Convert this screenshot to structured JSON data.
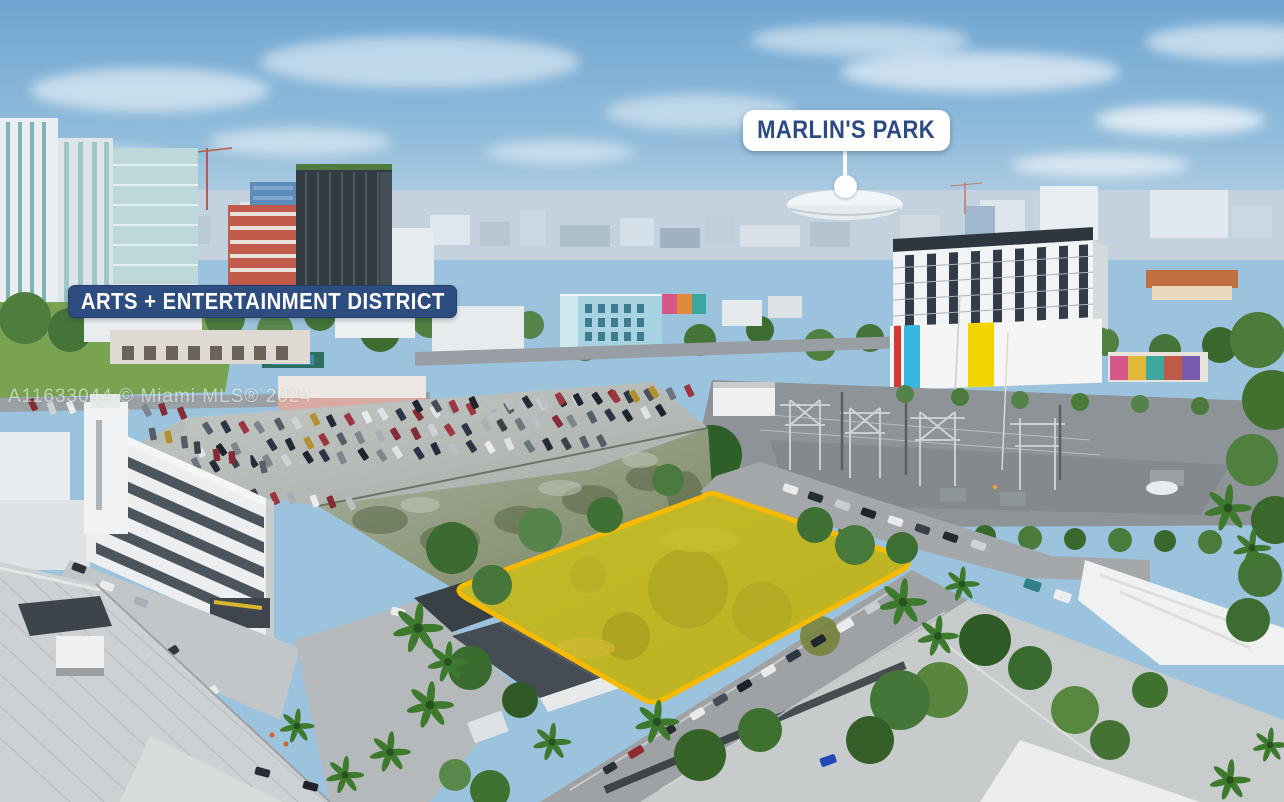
{
  "annotations": {
    "callout": {
      "label": "MARLIN'S PARK"
    },
    "district_banner": {
      "label": "ARTS + ENTERTAINMENT DISTRICT"
    },
    "watermark": {
      "text": "A11633044 © Miami MLS® 2024"
    },
    "property_outline": {
      "stroke": "#f6bb00",
      "fill": "rgba(252,214,0,0.40)"
    },
    "colors": {
      "banner_navy": "#2d4c80",
      "callout_text_navy": "#2b4a85",
      "callout_bg": "#ffffff"
    }
  }
}
